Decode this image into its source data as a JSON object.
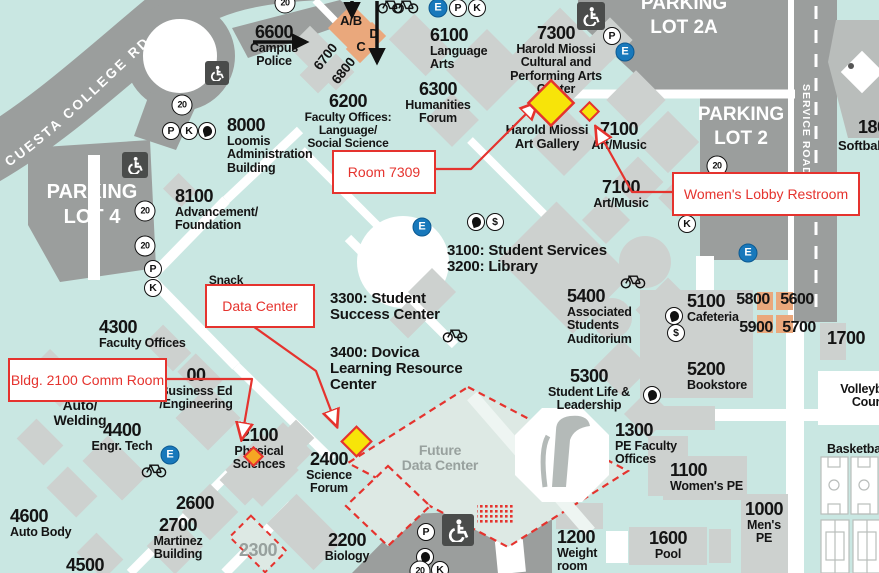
{
  "colors": {
    "ground": "#c9e7e2",
    "road_gray": "#9b9e9d",
    "building_gray": "#cdd1cf",
    "orange_building": "#eaa87c",
    "annotation_red": "#e5332e",
    "marker_yellow": "#f7e409",
    "marker_orange": "#f5a623",
    "emergency_blue": "#1878bb",
    "muted_text": "#98a19e"
  },
  "roads": {
    "cuesta": "CUESTA COLLEGE RD",
    "service": "SERVICE ROAD"
  },
  "parking": {
    "lot4": "PARKING\nLOT 4",
    "lot2a": "PARKING\nLOT 2A",
    "lot2": "PARKING\nLOT 2"
  },
  "callouts": {
    "room_7309": "Room 7309",
    "womens_lobby": "Women's Lobby Restroom",
    "data_center": "Data Center",
    "comm_room": "Bldg. 2100 Comm Room"
  },
  "labels": [
    {
      "name": "bldg-6600-campus-police",
      "num": "6600",
      "text": "Campus\nPolice",
      "x": 274,
      "y": 23,
      "al": "c"
    },
    {
      "name": "shuttle-stop-ab",
      "text": "A/B",
      "x": 351,
      "y": 14,
      "al": "c",
      "ts": 13
    },
    {
      "name": "shuttle-stop-d",
      "text": "D",
      "x": 374,
      "y": 27,
      "al": "c",
      "ts": 13
    },
    {
      "name": "shuttle-stop-c",
      "text": "C",
      "x": 361,
      "y": 40,
      "al": "c",
      "ts": 13
    },
    {
      "name": "bldg-6700",
      "text": "6700",
      "x": 326,
      "y": 50,
      "al": "c",
      "ts": 13.5,
      "rot": -52
    },
    {
      "name": "bldg-6800",
      "text": "6800",
      "x": 344,
      "y": 64,
      "al": "c",
      "ts": 13.5,
      "rot": -52
    },
    {
      "name": "bldg-6100-language-arts",
      "num": "6100",
      "text": "Language\nArts",
      "x": 430,
      "y": 26,
      "al": "l"
    },
    {
      "name": "bldg-6300-humanities-forum",
      "num": "6300",
      "text": "Humanities\nForum",
      "x": 438,
      "y": 80,
      "al": "c"
    },
    {
      "name": "bldg-6200-faculty-offices",
      "num": "6200",
      "text": "Faculty Offices:\nLanguage/\nSocial Science",
      "x": 348,
      "y": 92,
      "al": "c",
      "ts": 12
    },
    {
      "name": "bldg-7300-performing-arts",
      "num": "7300",
      "text": "Harold Miossi\nCultural and\nPerforming Arts\nCenter",
      "x": 556,
      "y": 24,
      "al": "c"
    },
    {
      "name": "harold-miossi-art-gallery",
      "text": "Harold Miossi\nArt Gallery",
      "x": 547,
      "y": 123,
      "al": "c",
      "ts": 13
    },
    {
      "name": "bldg-7100-art-music-upper",
      "num": "7100",
      "text": "Art/Music",
      "x": 619,
      "y": 120,
      "al": "c"
    },
    {
      "name": "bldg-7100-art-music-lower",
      "num": "7100",
      "text": "Art/Music",
      "x": 621,
      "y": 178,
      "al": "c"
    },
    {
      "name": "bldg-8000-loomis-admin",
      "num": "8000",
      "text": "Loomis\nAdministration\nBuilding",
      "x": 227,
      "y": 116,
      "al": "l"
    },
    {
      "name": "bldg-8100-advancement",
      "num": "8100",
      "text": "Advancement/\nFoundation",
      "x": 175,
      "y": 187,
      "al": "l"
    },
    {
      "name": "bldg-4300-faculty-offices",
      "num": "4300",
      "text": "Faculty Offices",
      "x": 99,
      "y": 318,
      "al": "l"
    },
    {
      "name": "snack-shack",
      "text": "Snack",
      "x": 226,
      "y": 274,
      "al": "c",
      "ts": 12
    },
    {
      "name": "bldg-auto-welding",
      "text": "Auto/\nWelding",
      "x": 80,
      "y": 398,
      "al": "c",
      "ts": 14
    },
    {
      "name": "bldg-4400-engr-tech",
      "num": "4400",
      "text": "Engr. Tech",
      "x": 122,
      "y": 421,
      "al": "c"
    },
    {
      "name": "bldg-4600-auto-body",
      "num": "4600",
      "text": "Auto Body",
      "x": 10,
      "y": 507,
      "al": "l"
    },
    {
      "name": "bldg-4500",
      "num": "4500",
      "x": 85,
      "y": 556,
      "al": "c"
    },
    {
      "name": "bldg-2600",
      "num": "2600",
      "x": 195,
      "y": 494,
      "al": "c"
    },
    {
      "name": "bldg-2700-martinez",
      "num": "2700",
      "text": "Martinez\nBuilding",
      "x": 178,
      "y": 516,
      "al": "c"
    },
    {
      "name": "bldg-2300",
      "num": "2300",
      "x": 258,
      "y": 541,
      "al": "c",
      "col": "#98a19e"
    },
    {
      "name": "bldg-2200-biology",
      "num": "2200",
      "text": "Biology",
      "x": 347,
      "y": 531,
      "al": "c"
    },
    {
      "name": "bldg-2400-science-forum",
      "num": "2400",
      "text": "Science\nForum",
      "x": 329,
      "y": 450,
      "al": "c"
    },
    {
      "name": "bldg-2100-physical-sciences",
      "num": "2100",
      "text": "Physical\nSciences",
      "x": 259,
      "y": 426,
      "al": "c"
    },
    {
      "name": "bldg-business-ed",
      "num": "00",
      "text": "Business Ed\n/Engineering",
      "x": 196,
      "y": 366,
      "al": "c"
    },
    {
      "name": "bldg-3100-3200",
      "text": "3100: Student Services\n3200: Library",
      "x": 447,
      "y": 243,
      "al": "l",
      "ts": 15
    },
    {
      "name": "bldg-3300-success-center",
      "text": "3300: Student\nSuccess Center",
      "x": 330,
      "y": 291,
      "al": "l",
      "ts": 15
    },
    {
      "name": "bldg-3400-learning-resource",
      "text": "3400: Dovica\nLearning Resource\nCenter",
      "x": 330,
      "y": 345,
      "al": "l",
      "ts": 15
    },
    {
      "name": "bldg-5400-auditorium",
      "num": "5400",
      "text": "Associated\nStudents\nAuditorium",
      "x": 567,
      "y": 287,
      "al": "l"
    },
    {
      "name": "bldg-5300-student-life",
      "num": "5300",
      "text": "Student Life &\nLeadership",
      "x": 589,
      "y": 367,
      "al": "c"
    },
    {
      "name": "bldg-5100-cafeteria",
      "num": "5100",
      "text": "Cafeteria",
      "x": 687,
      "y": 292,
      "al": "l"
    },
    {
      "name": "bldg-5200-bookstore",
      "num": "5200",
      "text": "Bookstore",
      "x": 687,
      "y": 360,
      "al": "l"
    },
    {
      "name": "bldg-5800",
      "num": "5800",
      "x": 753,
      "y": 292,
      "al": "c",
      "ns": 16
    },
    {
      "name": "bldg-5600",
      "num": "5600",
      "x": 797,
      "y": 292,
      "al": "c",
      "ns": 16
    },
    {
      "name": "bldg-5900",
      "num": "5900",
      "x": 756,
      "y": 320,
      "al": "c",
      "ns": 16
    },
    {
      "name": "bldg-5700",
      "num": "5700",
      "x": 799,
      "y": 320,
      "al": "c",
      "ns": 16
    },
    {
      "name": "bldg-1700",
      "num": "1700",
      "x": 827,
      "y": 329,
      "al": "l"
    },
    {
      "name": "volleyball-court",
      "text": "Volleyball\nCourt",
      "x": 868,
      "y": 383,
      "al": "c",
      "ts": 12.5
    },
    {
      "name": "basketball-courts",
      "text": "Basketball",
      "x": 827,
      "y": 443,
      "al": "l",
      "ts": 12.5
    },
    {
      "name": "bldg-1300-pe-faculty",
      "num": "1300",
      "text": "PE Faculty\nOffices",
      "x": 615,
      "y": 421,
      "al": "l"
    },
    {
      "name": "bldg-1100-womens-pe",
      "num": "1100",
      "text": "Women's PE",
      "x": 670,
      "y": 461,
      "al": "l"
    },
    {
      "name": "bldg-1200-weight-room",
      "num": "1200",
      "text": "Weight\nroom",
      "x": 557,
      "y": 528,
      "al": "l"
    },
    {
      "name": "bldg-1600-pool",
      "num": "1600",
      "text": "Pool",
      "x": 668,
      "y": 529,
      "al": "c"
    },
    {
      "name": "bldg-1000-mens-pe",
      "num": "1000",
      "text": "Men's\nPE",
      "x": 764,
      "y": 500,
      "al": "c"
    },
    {
      "name": "future-data-center",
      "text": "Future\nData Center",
      "x": 440,
      "y": 443,
      "al": "c",
      "ts": 14,
      "col": "#98a19e"
    },
    {
      "name": "bldg-1800",
      "num": "1800",
      "x": 858,
      "y": 118,
      "al": "l"
    },
    {
      "name": "softball-field",
      "text": "Softball",
      "x": 838,
      "y": 139,
      "al": "l",
      "ts": 13
    }
  ],
  "icons": [
    {
      "t": "E",
      "x": 438,
      "y": 8,
      "g": "E"
    },
    {
      "t": "P",
      "x": 458,
      "y": 8,
      "g": "P"
    },
    {
      "t": "K",
      "x": 477,
      "y": 8,
      "g": "K"
    },
    {
      "t": "20",
      "x": 285,
      "y": 3,
      "g": "20"
    },
    {
      "t": "20",
      "x": 182,
      "y": 105,
      "g": "20"
    },
    {
      "t": "hc",
      "x": 217,
      "y": 73,
      "s": 24
    },
    {
      "t": "hc",
      "x": 135,
      "y": 165,
      "s": 26
    },
    {
      "t": "hc",
      "x": 591,
      "y": 16,
      "s": 28
    },
    {
      "t": "hc",
      "x": 458,
      "y": 530,
      "s": 32
    },
    {
      "t": "P",
      "x": 612,
      "y": 36,
      "g": "P"
    },
    {
      "t": "E",
      "x": 625,
      "y": 52,
      "g": "E"
    },
    {
      "t": "P",
      "x": 171,
      "y": 131,
      "g": "P"
    },
    {
      "t": "K",
      "x": 189,
      "y": 131,
      "g": "K"
    },
    {
      "t": "J",
      "x": 207,
      "y": 131
    },
    {
      "t": "20",
      "x": 145,
      "y": 211,
      "g": "20"
    },
    {
      "t": "20",
      "x": 145,
      "y": 246,
      "g": "20"
    },
    {
      "t": "P",
      "x": 153,
      "y": 269,
      "g": "P"
    },
    {
      "t": "K",
      "x": 153,
      "y": 288,
      "g": "K"
    },
    {
      "t": "20",
      "x": 717,
      "y": 166,
      "g": "20"
    },
    {
      "t": "K",
      "x": 687,
      "y": 224,
      "g": "K"
    },
    {
      "t": "E",
      "x": 748,
      "y": 253,
      "g": "E"
    },
    {
      "t": "E",
      "x": 422,
      "y": 227,
      "g": "E"
    },
    {
      "t": "J",
      "x": 476,
      "y": 222
    },
    {
      "t": "S",
      "x": 495,
      "y": 222,
      "g": "$"
    },
    {
      "t": "J",
      "x": 674,
      "y": 316
    },
    {
      "t": "S",
      "x": 676,
      "y": 333,
      "g": "$"
    },
    {
      "t": "J",
      "x": 652,
      "y": 395
    },
    {
      "t": "E",
      "x": 170,
      "y": 455,
      "g": "E"
    },
    {
      "t": "P",
      "x": 426,
      "y": 532,
      "g": "P"
    },
    {
      "t": "J",
      "x": 425,
      "y": 557
    },
    {
      "t": "20",
      "x": 420,
      "y": 571,
      "g": "20"
    },
    {
      "t": "K",
      "x": 440,
      "y": 570,
      "g": "K"
    },
    {
      "t": "bike",
      "x": 390,
      "y": 6
    },
    {
      "t": "bike",
      "x": 406,
      "y": 6
    },
    {
      "t": "bike",
      "x": 633,
      "y": 281
    },
    {
      "t": "bike",
      "x": 455,
      "y": 335
    },
    {
      "t": "bike",
      "x": 154,
      "y": 470
    }
  ]
}
